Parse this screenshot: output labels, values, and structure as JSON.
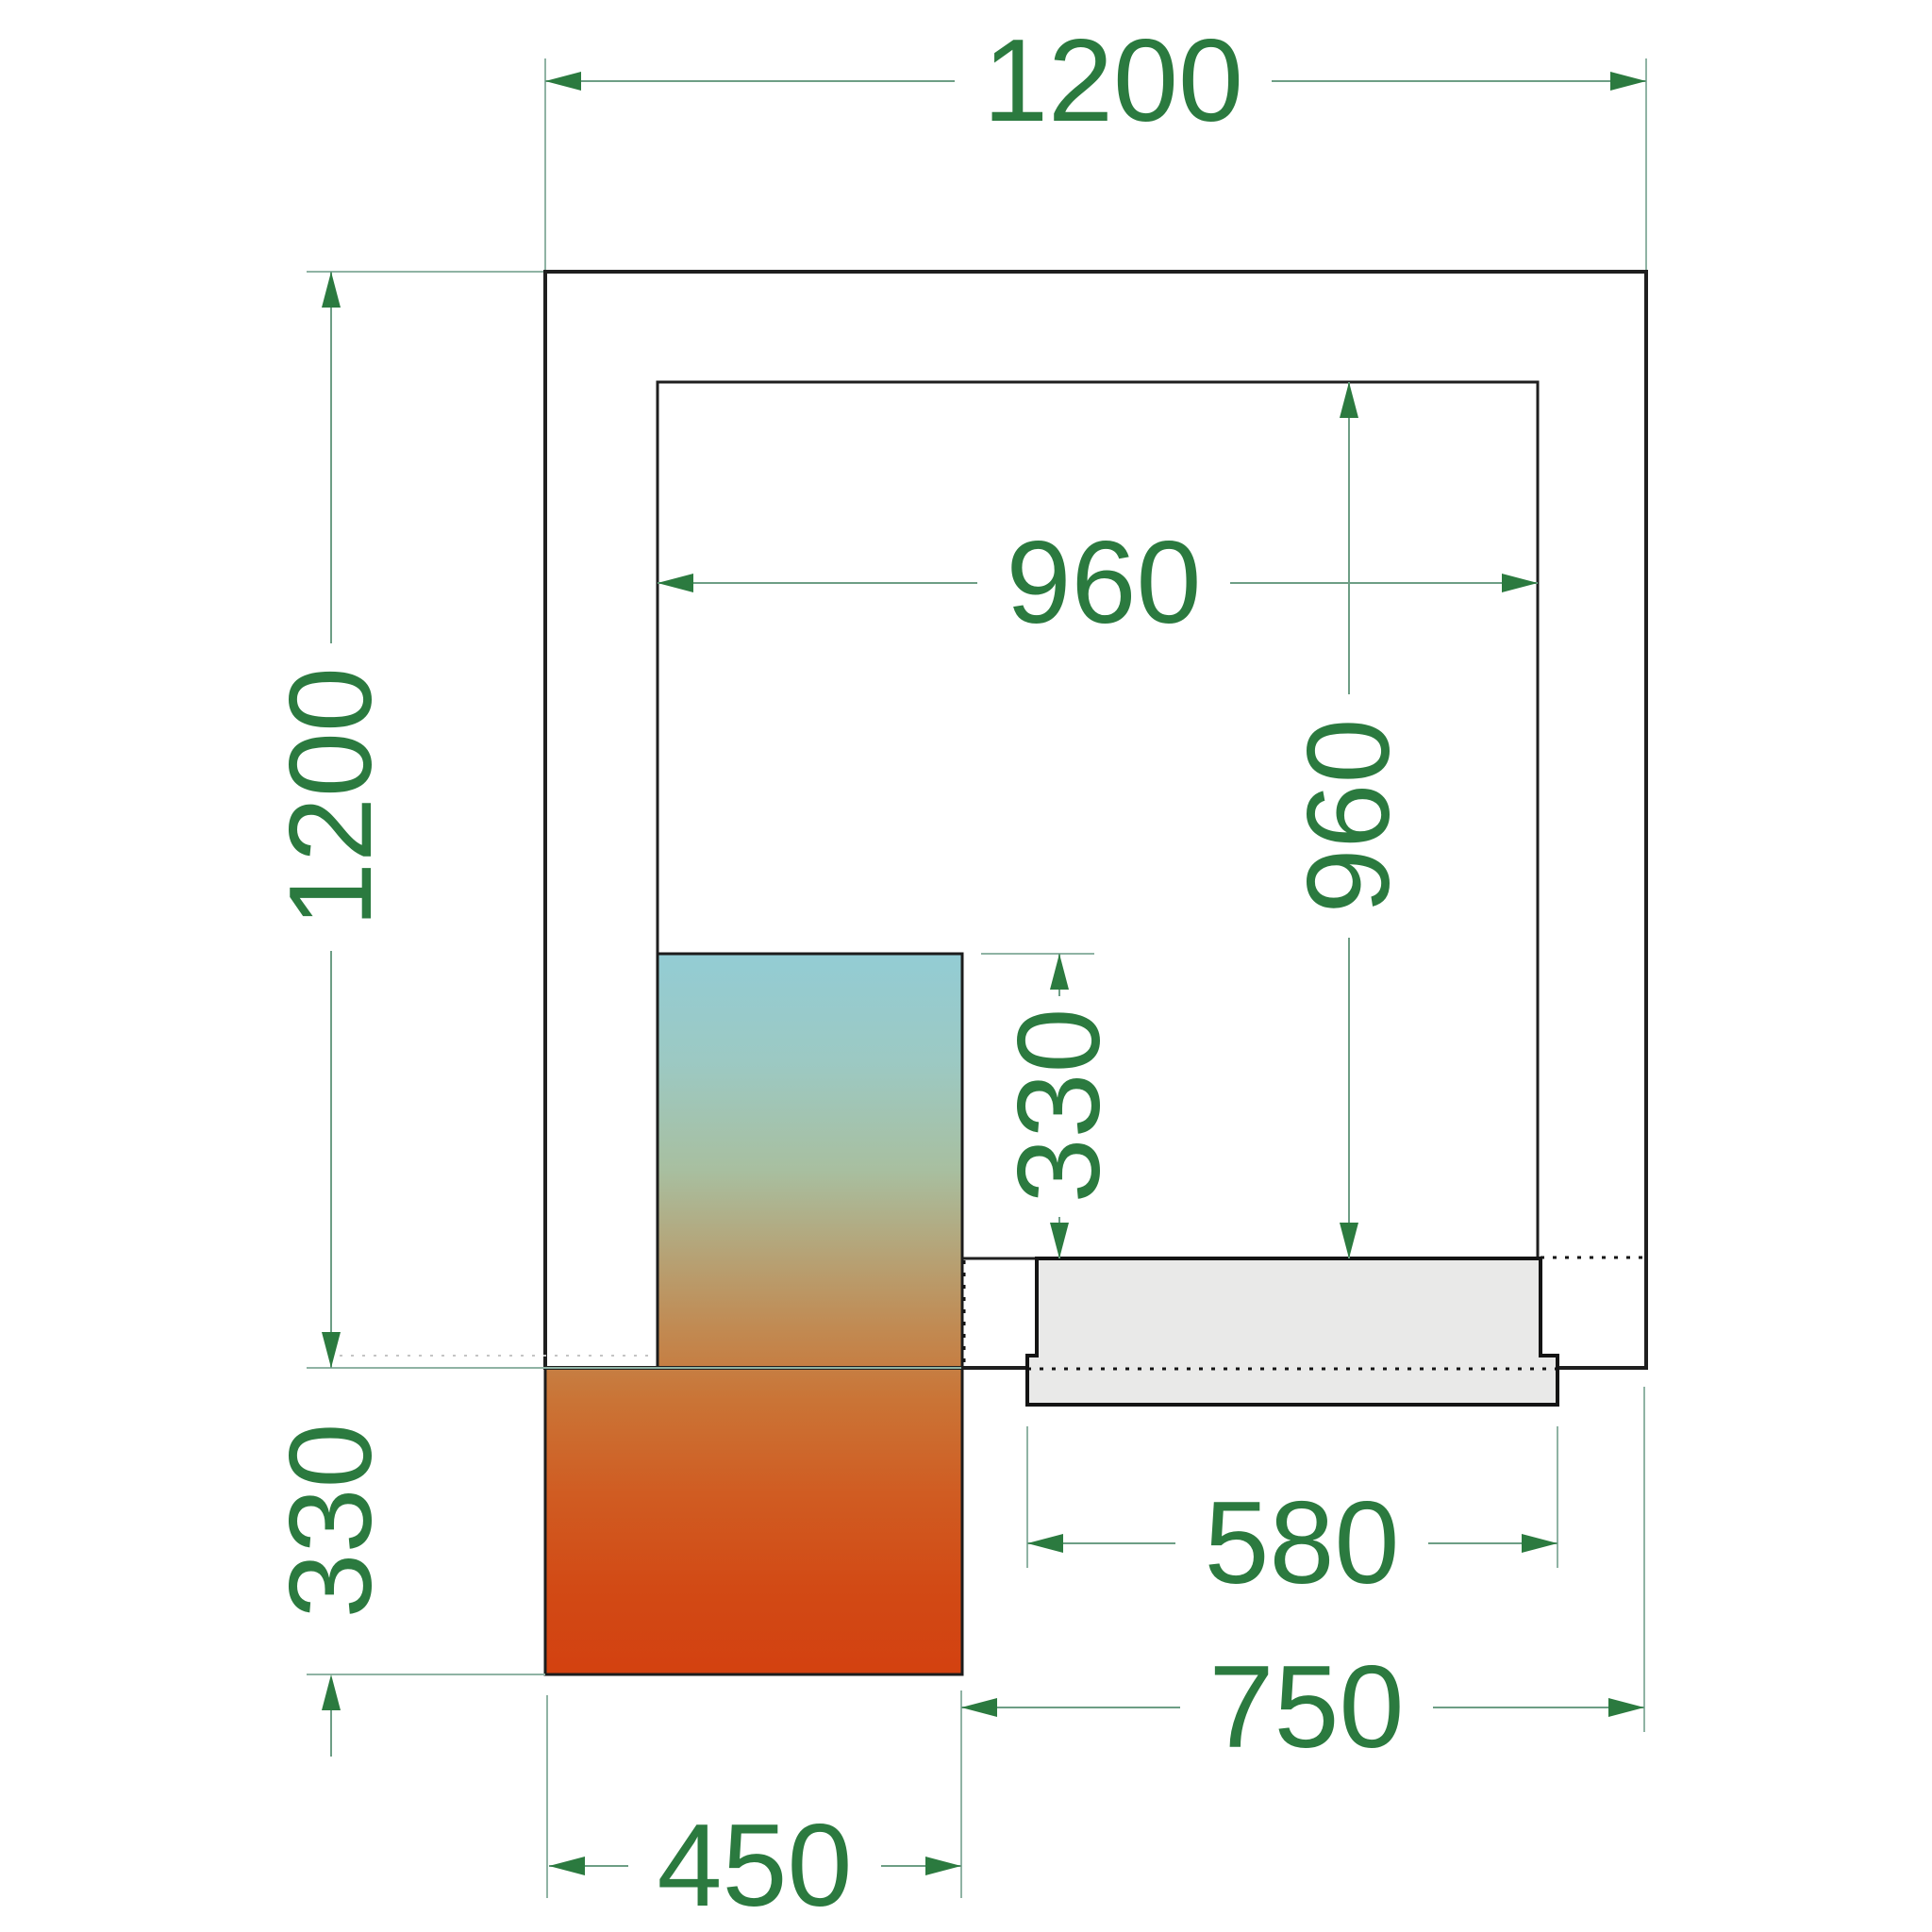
{
  "drawing": {
    "title": "Cold room floor plan (top view)",
    "units": "mm",
    "dims": {
      "outer_width": "1200",
      "outer_depth": "1200",
      "inner_width": "960",
      "inner_depth": "960",
      "unit_depth_inside": "330",
      "unit_depth_outside": "330",
      "door_width": "580",
      "door_span": "750",
      "unit_width": "450"
    },
    "colors": {
      "dimension_text": "#2b7a3f",
      "dimension_arrow": "#2b7a3f",
      "dimension_line": "#6d9e85",
      "extension_line": "#8fb3a4",
      "wall_line": "#1f1f1f",
      "door_fill": "#e9e9e8",
      "unit_gradient_top": "#93ccd4",
      "unit_gradient_middle": "#b6a275",
      "unit_gradient_bottom": "#d34110"
    }
  }
}
